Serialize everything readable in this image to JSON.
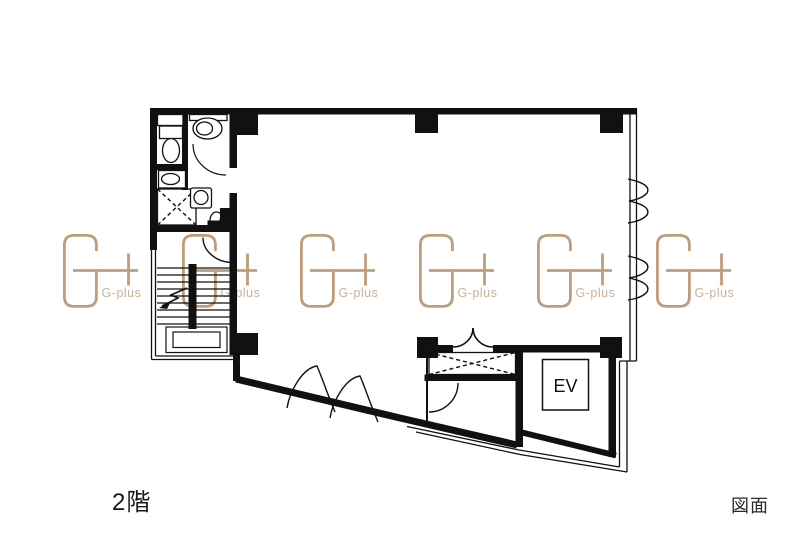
{
  "labels": {
    "floor": "2階",
    "drawing": "図面",
    "elevator": "EV"
  },
  "watermark": {
    "text": "G-plus",
    "instances": 6
  },
  "colors": {
    "background": "#ffffff",
    "plan_line": "#111111",
    "watermark_stroke": "#c09d7a",
    "watermark_text": "#ccb098"
  }
}
